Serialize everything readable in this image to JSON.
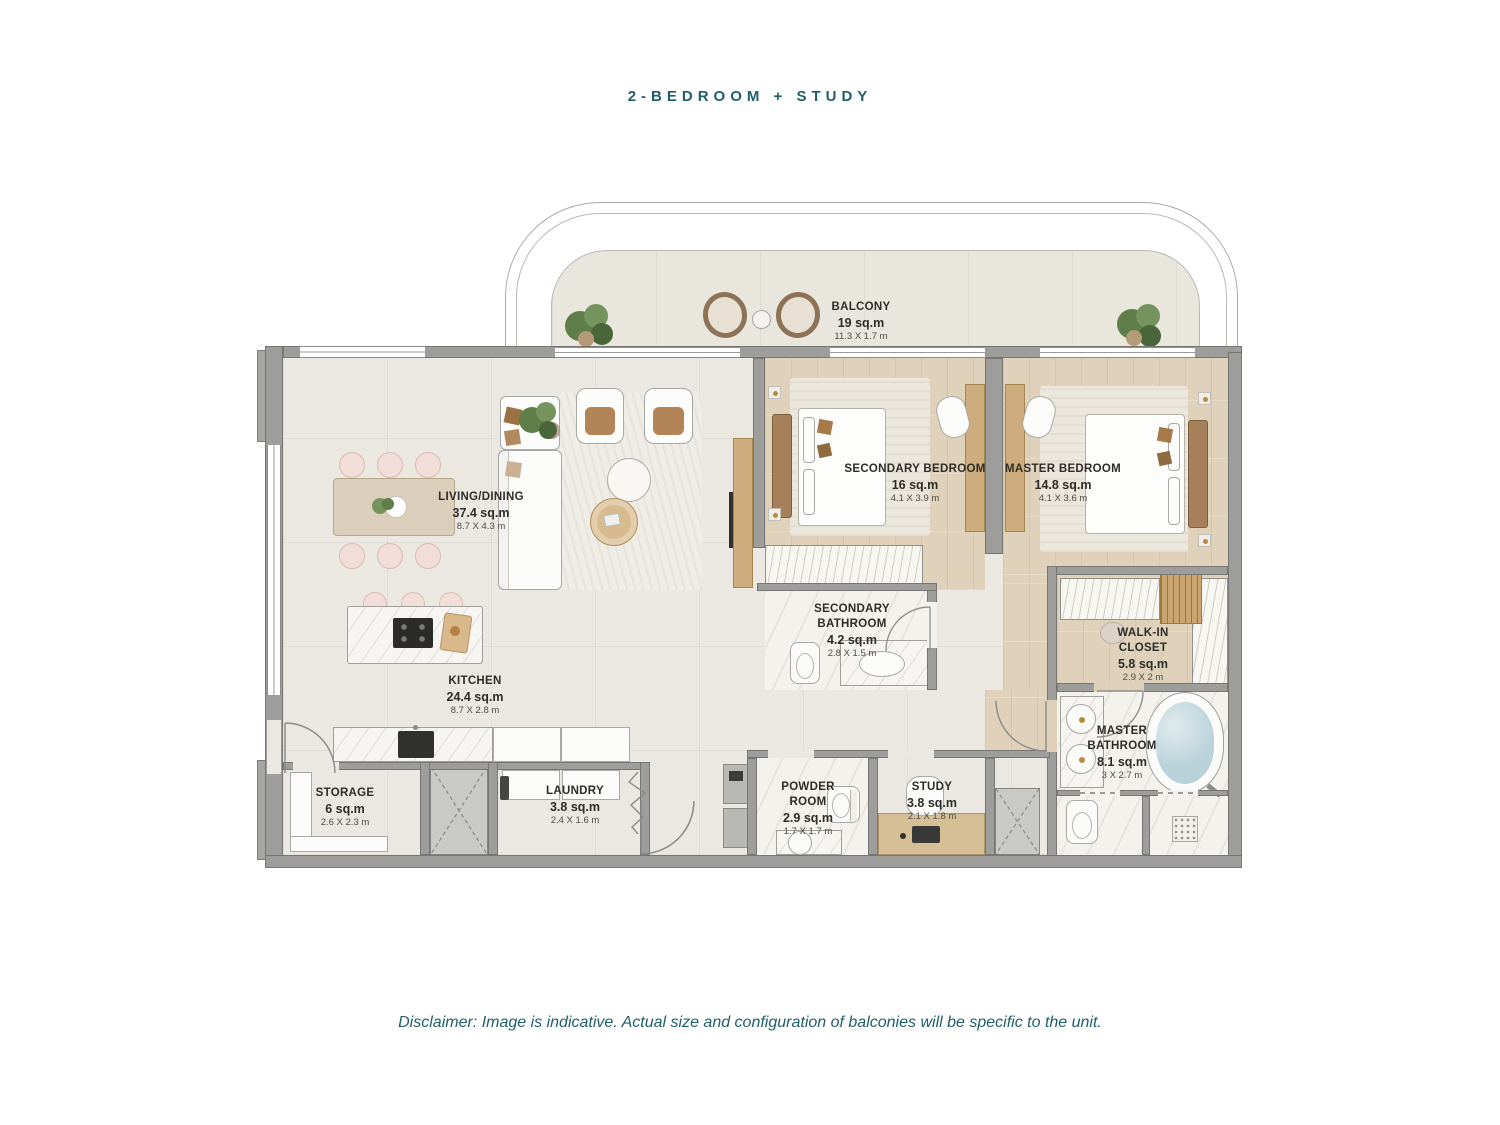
{
  "page": {
    "title": "2-BEDROOM + STUDY",
    "disclaimer": "Disclaimer: Image is indicative. Actual size and configuration of balconies will be specific to the unit."
  },
  "colors": {
    "accent": "#1F5F68",
    "wall": "#9D9D9B",
    "floor": "#EAE8E0",
    "wood": "#E0D2BA",
    "marble": "#F4F2ED",
    "water": "#B9D2DA"
  },
  "rooms": [
    {
      "id": "balcony",
      "name": "BALCONY",
      "area": "19 sq.m",
      "dims": "11.3 X 1.7 m"
    },
    {
      "id": "living_dining",
      "name": "LIVING/DINING",
      "area": "37.4 sq.m",
      "dims": "8.7 X 4.3 m"
    },
    {
      "id": "kitchen",
      "name": "KITCHEN",
      "area": "24.4 sq.m",
      "dims": "8.7 X 2.8 m"
    },
    {
      "id": "secondary_bedroom",
      "name": "SECONDARY BEDROOM",
      "area": "16 sq.m",
      "dims": "4.1 X 3.9 m"
    },
    {
      "id": "master_bedroom",
      "name": "MASTER BEDROOM",
      "area": "14.8 sq.m",
      "dims": "4.1 X 3.6 m"
    },
    {
      "id": "secondary_bathroom",
      "name": "SECONDARY BATHROOM",
      "area": "4.2 sq.m",
      "dims": "2.8 X 1.5 m"
    },
    {
      "id": "walk_in_closet",
      "name": "WALK-IN CLOSET",
      "area": "5.8 sq.m",
      "dims": "2.9 X 2 m"
    },
    {
      "id": "master_bathroom",
      "name": "MASTER BATHROOM",
      "area": "8.1 sq.m",
      "dims": "3 X 2.7 m"
    },
    {
      "id": "storage",
      "name": "STORAGE",
      "area": "6 sq.m",
      "dims": "2.6 X 2.3 m"
    },
    {
      "id": "laundry",
      "name": "LAUNDRY",
      "area": "3.8 sq.m",
      "dims": "2.4 X 1.6 m"
    },
    {
      "id": "powder_room",
      "name": "POWDER ROOM",
      "area": "2.9 sq.m",
      "dims": "1.7 X 1.7 m"
    },
    {
      "id": "study",
      "name": "STUDY",
      "area": "3.8 sq.m",
      "dims": "2.1 X 1.8 m"
    }
  ]
}
